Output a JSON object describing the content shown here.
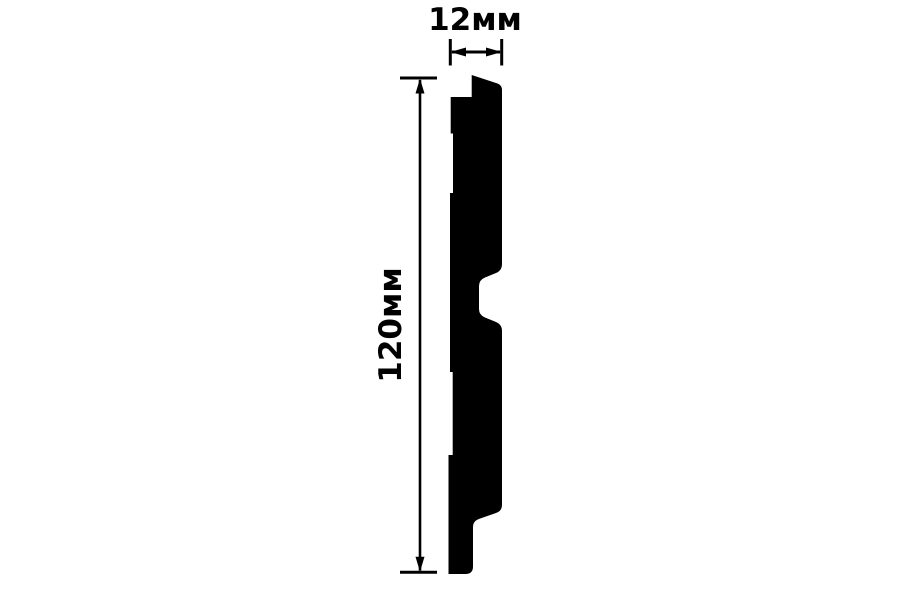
{
  "drawing": {
    "description": "Cross-section profile drawing of a wall panel plank with width and height dimensions",
    "background": "#ffffff",
    "ink": "#000000"
  },
  "profile": {
    "name": "wall-panel-cross-section",
    "fill": "#000000",
    "path": "M471.7,75 L497.5,83.5 Q502,85.2 502,90 L502,264 Q502,270.5 496,273 L485,277.5 Q479,280 479,286 L479,309 Q479,315 485,317.5 L496,322 Q502,324.5 502,331 L502,505 Q502,511 496,513 L479.5,518.8 Q473,521 473,527 L473,566.5 Q473,574 465.5,574 L448.5,574 L448.5,455 L452.7,455 L452.7,372 L450,372 L450,193 L453,193 L453,133.5 L450.7,133.5 L450.7,97 L471.7,97 Z"
  },
  "dimensions": {
    "width": {
      "label": "12мм",
      "value": 12,
      "unit": "мм"
    },
    "height": {
      "label": "120мм",
      "value": 120,
      "unit": "мм"
    }
  }
}
